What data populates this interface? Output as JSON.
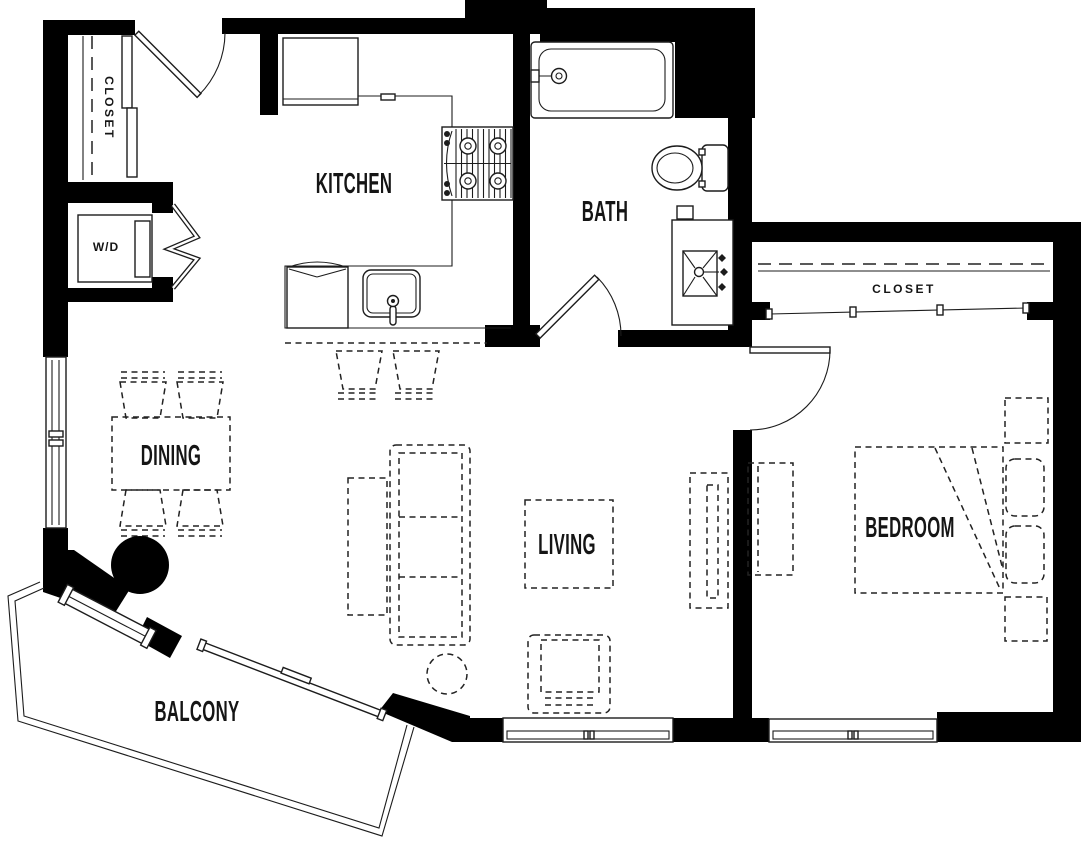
{
  "plan": {
    "type": "apartment-floor-plan",
    "rooms": {
      "kitchen": {
        "label": "KITCHEN"
      },
      "bath": {
        "label": "BATH"
      },
      "dining": {
        "label": "DINING"
      },
      "living": {
        "label": "LIVING"
      },
      "bedroom": {
        "label": "BEDROOM"
      },
      "balcony": {
        "label": "BALCONY"
      },
      "entry_closet": {
        "label": "CLOSET"
      },
      "bedroom_closet": {
        "label": "CLOSET"
      },
      "laundry": {
        "label": "W/D"
      }
    },
    "colors": {
      "walls": "#000000",
      "linework": "#1c1c1c",
      "background": "#ffffff"
    },
    "fixture_icons": [
      "refrigerator-icon",
      "range-icon",
      "kitchen-sink-icon",
      "dishwasher-icon",
      "bar-stool-icon",
      "bathtub-icon",
      "toilet-icon",
      "vanity-sink-icon",
      "washer-dryer-icon",
      "dining-table-icon",
      "dining-chair-icon",
      "column-icon",
      "sofa-icon",
      "console-table-icon",
      "coffee-table-icon",
      "accent-table-icon",
      "armchair-icon",
      "tv-console-icon",
      "bed-icon",
      "pillow-icon",
      "nightstand-icon",
      "dresser-icon",
      "entry-door-icon",
      "bath-door-icon",
      "bedroom-door-icon",
      "bifold-door-icon",
      "sliding-closet-door-icon",
      "balcony-slider-icon",
      "window-icon"
    ]
  }
}
